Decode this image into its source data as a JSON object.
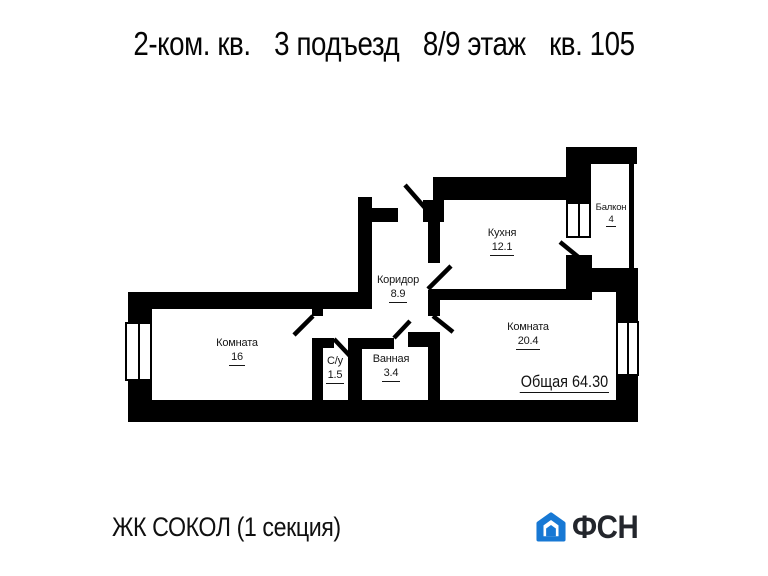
{
  "title": {
    "parts": [
      "2-ком. кв.",
      "3 подъезд",
      "8/9 этаж",
      "кв. 105"
    ]
  },
  "plan": {
    "rooms": [
      {
        "name": "Комната",
        "area": "16"
      },
      {
        "name": "С/у",
        "area": "1.5"
      },
      {
        "name": "Ванная",
        "area": "3.4"
      },
      {
        "name": "Коридор",
        "area": "8.9"
      },
      {
        "name": "Кухня",
        "area": "12.1"
      },
      {
        "name": "Комната",
        "area": "20.4"
      },
      {
        "name": "Балкон",
        "area": "4"
      }
    ],
    "total_label": "Общая 64.30"
  },
  "footer": {
    "complex": "ЖК СОКОЛ (1 секция)",
    "logo_text": "ФСН"
  },
  "icons": {
    "logo": "house-outline"
  },
  "colors": {
    "logo_blue": "#1778d4",
    "ink": "#000000"
  }
}
